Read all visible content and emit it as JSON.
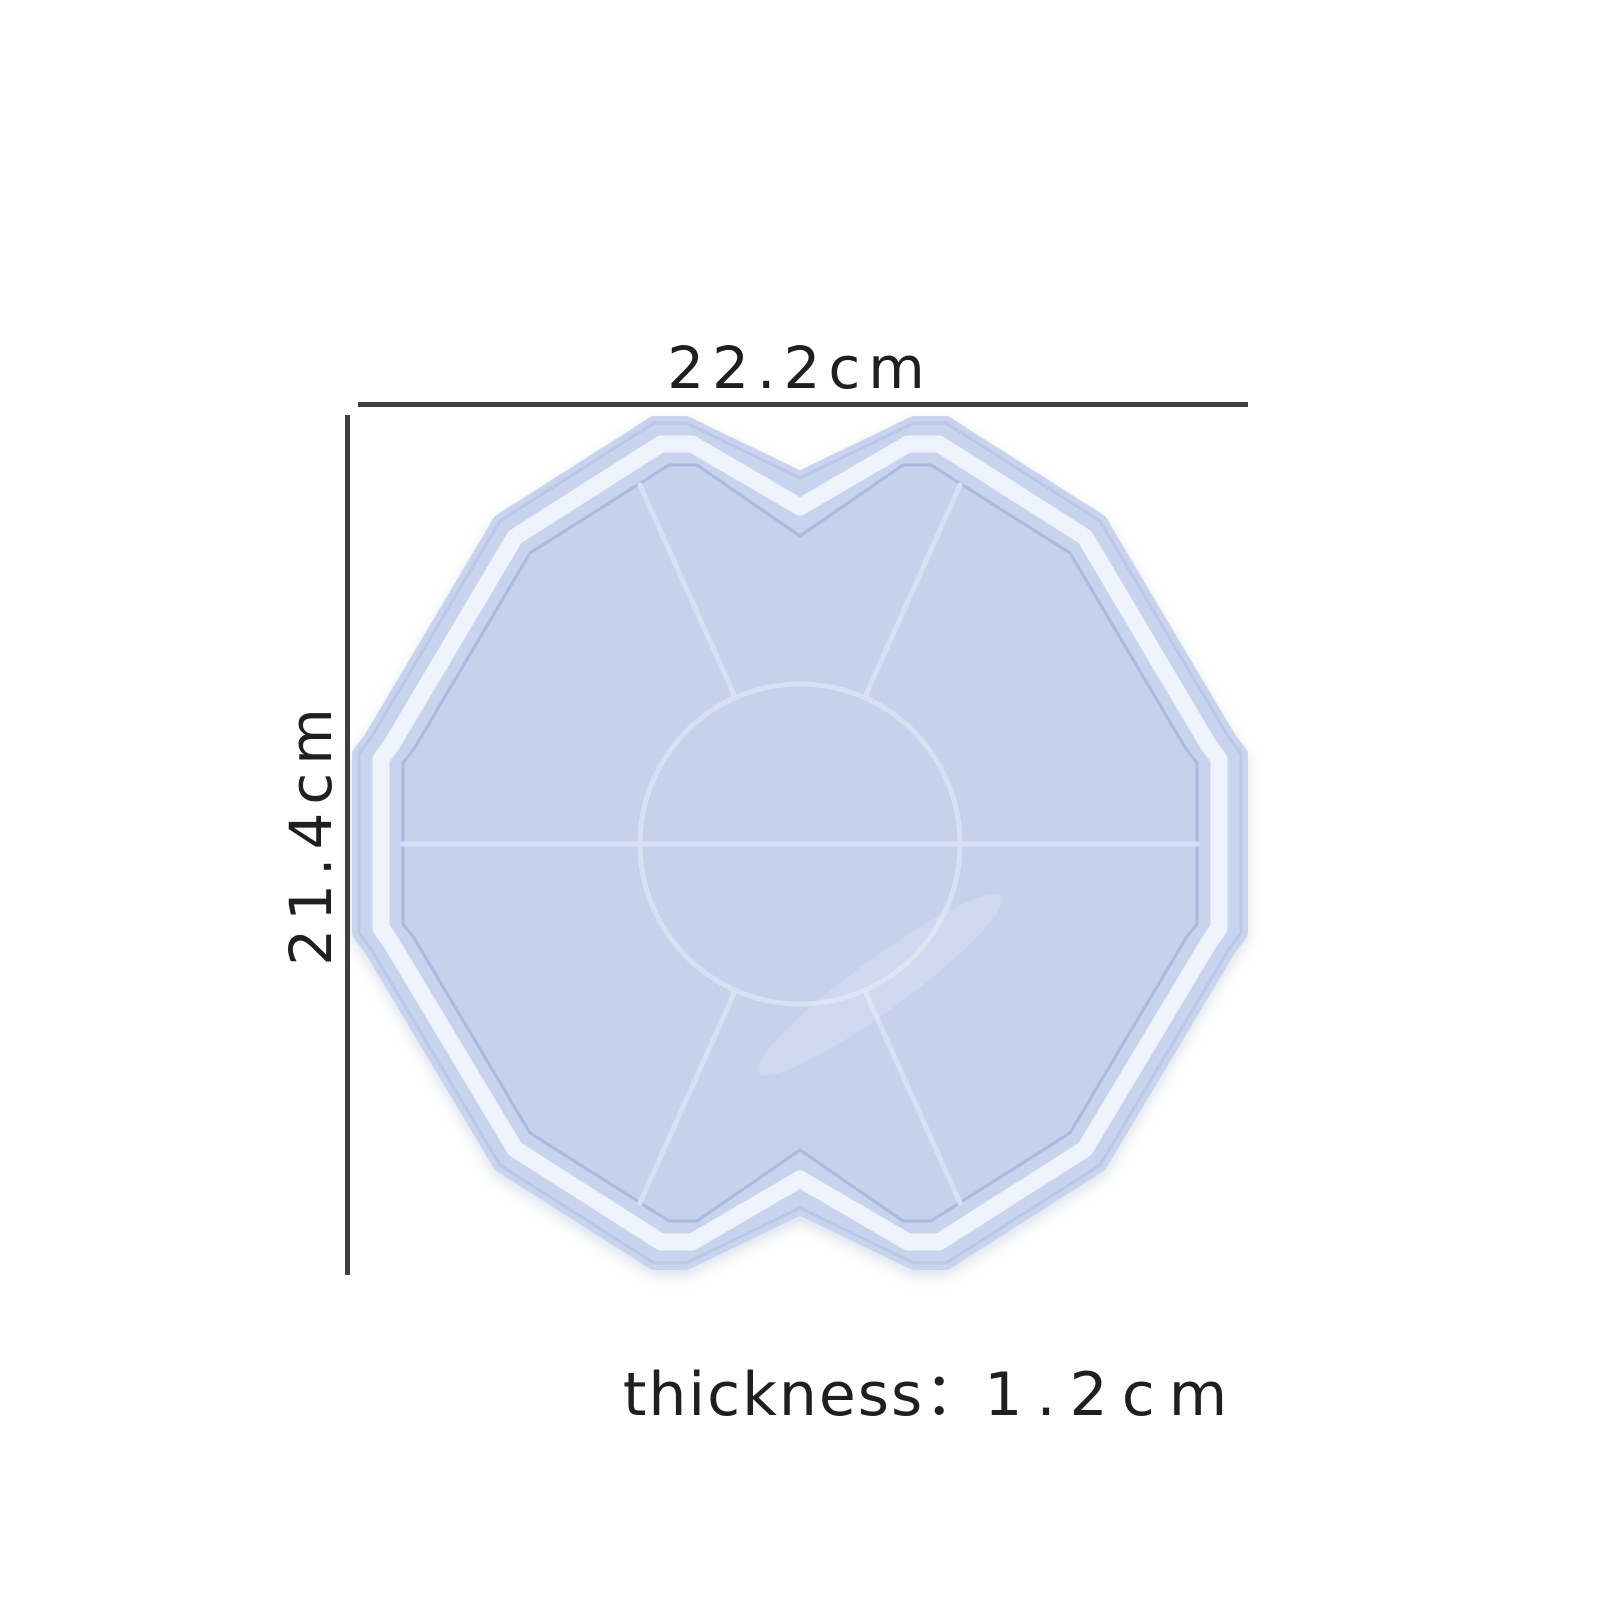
{
  "figure": {
    "width_label": "22.2cm",
    "height_label": "21.4cm",
    "thickness_label": "thickness",
    "thickness_separator": "：",
    "thickness_value": "1.2cm"
  },
  "colors": {
    "background": "#ffffff",
    "mold_body": "#c8d4ee",
    "mold_outline": "#b4c3e4",
    "rim_highlight": "#f1f5fc",
    "cavity_floor": "#c6d2ec",
    "cavity_edge_shadow": "#a9bade",
    "ridge_line": "#d8e0f3",
    "reflection": "#ffffff",
    "dimension_line": "#3f3f3f",
    "label_text": "#1f1f1f"
  }
}
